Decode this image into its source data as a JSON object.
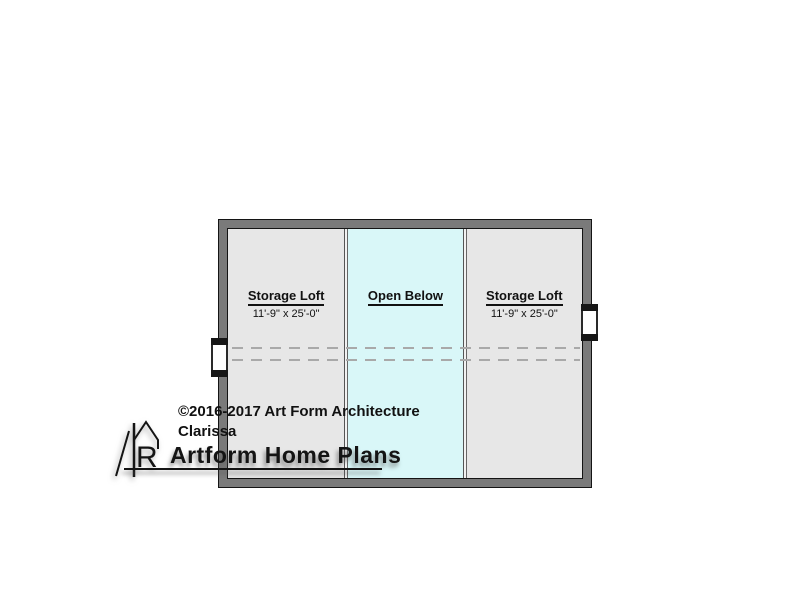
{
  "canvas": {
    "background": "#ffffff"
  },
  "plan": {
    "wall_color": "#7a7a7a",
    "outline_color": "#141414",
    "dash_line_color": "#a9a9a9",
    "rooms": [
      {
        "label": "Storage Loft",
        "dimensions": "11'-9\" x 25'-0\"",
        "fill": "#e7e7e7"
      },
      {
        "label": "Open Below",
        "dimensions": "",
        "fill": "#d9f7f8"
      },
      {
        "label": "Storage Loft",
        "dimensions": "11'-9\" x 25'-0\"",
        "fill": "#e7e7e7"
      }
    ]
  },
  "annotations": {
    "copyright": "©2016-2017 Art Form Architecture",
    "plan_name": "Clarissa"
  },
  "brand": {
    "name": "Artform Home Plans",
    "monogram_letter": "R"
  }
}
